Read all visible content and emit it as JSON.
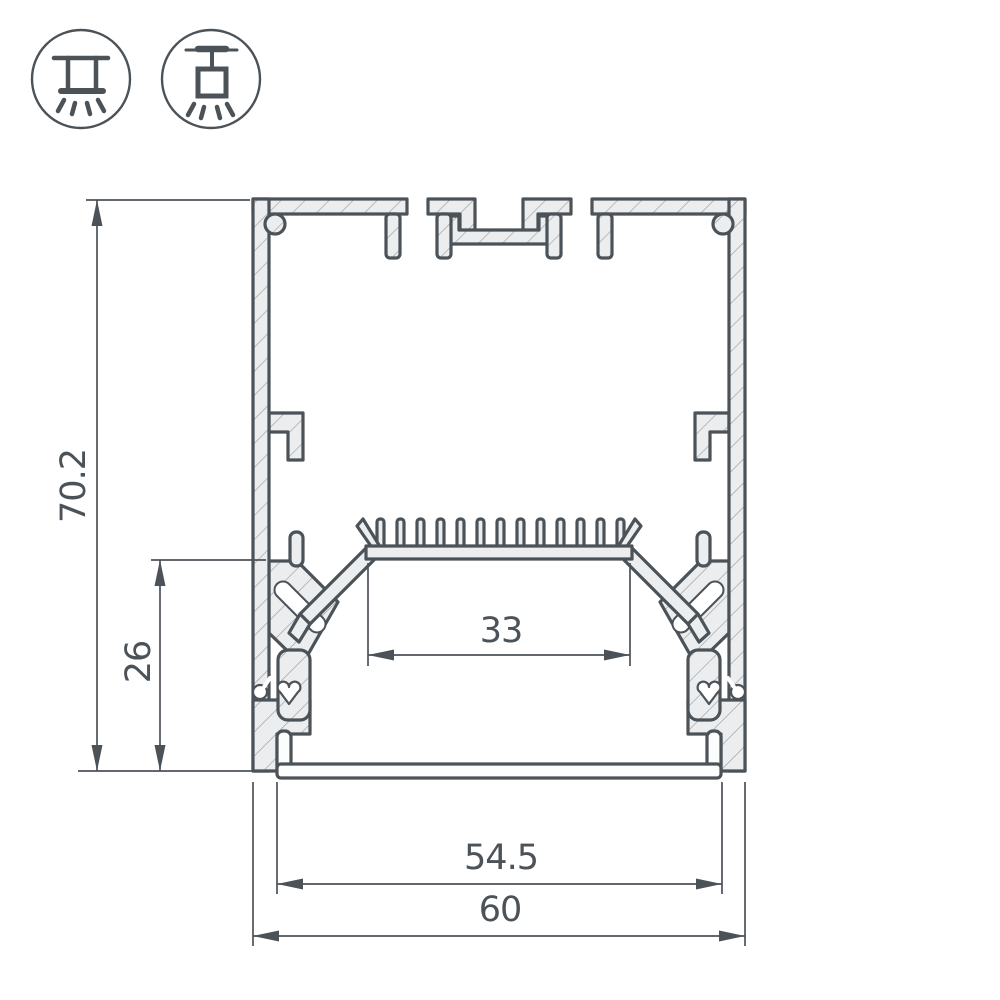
{
  "colors": {
    "line": "#4b5258",
    "fill": "#ecedee",
    "hatch": "#979da0",
    "diffuser": "#fcfdfd",
    "background": "#ffffff"
  },
  "icons": [
    {
      "name": "surface-mount-icon",
      "meaning": "surface-mounted luminaire"
    },
    {
      "name": "pendant-mount-icon",
      "meaning": "pendant suspended luminaire"
    }
  ],
  "dimensions": {
    "overall_height": "70.2",
    "led_level_height": "26",
    "led_shelf_width": "33",
    "inner_width": "54.5",
    "overall_width": "60"
  }
}
